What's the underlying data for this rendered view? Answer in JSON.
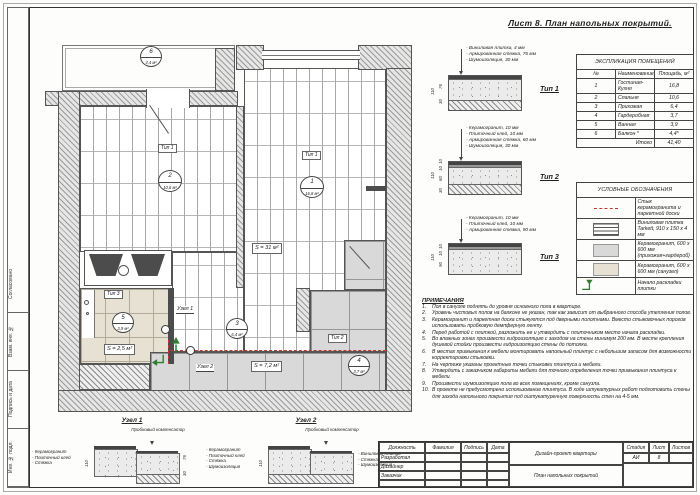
{
  "sheet": {
    "title": "Лист 8. План напольных покрытий."
  },
  "frame": {
    "stamps": [
      "Согласовано",
      "Взам. инв. №",
      "Подпись и дата",
      "Инв. № подл."
    ]
  },
  "explication": {
    "title": "ЭКСПЛИКАЦИЯ ПОМЕЩЕНИЙ",
    "col_num": "№",
    "col_name": "Наименование",
    "col_area": "Площадь, м²",
    "rows": [
      {
        "num": "1",
        "name": "Гостиная-Кухня",
        "area": "16,8"
      },
      {
        "num": "2",
        "name": "Спальня",
        "area": "10,6"
      },
      {
        "num": "3",
        "name": "Прихожая",
        "area": "6,4"
      },
      {
        "num": "4",
        "name": "Гардеробная",
        "area": "3,7"
      },
      {
        "num": "5",
        "name": "Ванная",
        "area": "3,9"
      },
      {
        "num": "6",
        "name": "Балкон *",
        "area": "4,4*"
      }
    ],
    "total_label": "Итого",
    "total": "41,40"
  },
  "legend": {
    "title": "УСЛОВНЫЕ ОБОЗНАЧЕНИЯ",
    "items": [
      {
        "label": "Стык керамогранита и паркетной доски"
      },
      {
        "label": "Виниловая плитка Tarkett, 910 х 150 х 4 мм"
      },
      {
        "label": "Керамогранит, 600 х 600 мм (прихожая+гардероб)"
      },
      {
        "label": "Керамогранит, 600 х 600 мм (санузел)"
      },
      {
        "label": "Начало раскладки плитки"
      }
    ]
  },
  "types": [
    {
      "name": "Тип 1",
      "lines": [
        "- Виниловая плитка, 4 мм",
        "- Армированная стяжка, 76 мм",
        "- Шумоизоляция, 30 мм"
      ],
      "dim_total": "110",
      "dims": [
        "76",
        "30"
      ]
    },
    {
      "name": "Тип 2",
      "lines": [
        "- Керамогранит, 10 мм",
        "- Плиточный клей, 10 мм",
        "- Армированная стяжка, 60 мм",
        "- Шумоизоляция, 30 мм"
      ],
      "dim_total": "110",
      "dims": [
        "10",
        "10",
        "60",
        "30"
      ]
    },
    {
      "name": "Тип 3",
      "lines": [
        "- Керамогранит, 10 мм",
        "- Плиточный клей, 10 мм",
        "- Армированная стяжка, 90 мм"
      ],
      "dim_total": "110",
      "dims": [
        "10",
        "10",
        "90"
      ]
    }
  ],
  "notes": {
    "title": "ПРИМЕЧАНИЯ",
    "items": [
      {
        "num": "1.",
        "text": "Пол в санузле поднять до уровня основного пола в квартире."
      },
      {
        "num": "2.",
        "text": "Уровень чистовых полов на балконе не указан, так как зависит от выбранного способа утепления полов."
      },
      {
        "num": "3.",
        "text": "Керамогранит и паркетная доска стыкуются под дверными полотнами. Вместо стыковочных порогов использовать пробковую демпферную ленту."
      },
      {
        "num": "4.",
        "text": "Перед работой с плиткой, разложить ее и утвердить с плиточником место начала раскладки."
      },
      {
        "num": "5.",
        "text": "Во влажных зонах произвести гидроизоляцию с заходом на стены минимум 200 мм. В месте крепления душевой стойки произвести гидроизоляцию стены до потолка."
      },
      {
        "num": "6.",
        "text": "В местах примыкания к мебели монтировать напольный плинтус с небольшим запасом для возможности корректировки стыковки."
      },
      {
        "num": "7.",
        "text": "На чертеже указаны проектные точки стыковки плинтуса и мебели."
      },
      {
        "num": "8.",
        "text": "Утвердить с заказчиком габариты мебели для точного определения точки примыкания плинтуса к мебели."
      },
      {
        "num": "9.",
        "text": "Произвести шумоизоляцию пола во всех помещениях, кроме санузла."
      },
      {
        "num": "10.",
        "text": "В проекте не предусмотрено использование плинтуса. В ходе штукатурных работ подготовить стены для захода напольного покрытия под оштукатуренную поверхность стен на 4-5 мм."
      }
    ]
  },
  "plan": {
    "markers": [
      {
        "num": "1",
        "area": "16,8 м²"
      },
      {
        "num": "2",
        "area": "10,6 м²"
      },
      {
        "num": "3",
        "area": "6,4 м²"
      },
      {
        "num": "4",
        "area": "3,7 м²"
      },
      {
        "num": "5",
        "area": "3,9 м²"
      },
      {
        "num": "6",
        "area": "4,4 м²"
      }
    ],
    "tags": {
      "bedroom": "Тип 1",
      "living": "Тип 1",
      "hall": "Тип 2",
      "bath": "Тип 3"
    },
    "s_living": "S = 31 м²",
    "s_bath": "S = 2,5 м²",
    "s_hall": "S = 7,2 м²",
    "node1": "Узел 1",
    "node2": "Узел 2"
  },
  "nodes": [
    {
      "title": "Узел 1",
      "comp": "Пробковый компенсатор",
      "left": [
        "- Керамогранит",
        "- Плиточный клей",
        "- Стяжка"
      ],
      "right": [],
      "dims_left": [
        "10",
        "110",
        "10",
        "90"
      ],
      "dims_right": [
        "76",
        "30"
      ]
    },
    {
      "title": "Узел 2",
      "comp": "Пробковый компенсатор",
      "left": [
        "- Керамогранит",
        "- Плиточный клей",
        "- Стяжка",
        "- Шумоизоляция"
      ],
      "right": [
        "- Виниловая плитка",
        "- Стяжка",
        "- Шумоизоляция"
      ],
      "dims_left": [
        "10",
        "110",
        "10",
        "60",
        "30"
      ],
      "dims_right": [
        "76",
        "30"
      ]
    }
  ],
  "titleblock": {
    "col_role": "Должность",
    "col_name": "Фамилия",
    "col_sign": "Подпись",
    "col_date": "Дата",
    "rows": [
      "Разработал",
      "Дизайнер",
      "Заказчик"
    ],
    "project": "Дизайн-проект квартиры",
    "doc": "План напольных покрытий",
    "stage_label": "Стадия",
    "sheet_label": "Лист",
    "sheets_label": "Листов",
    "stage": "АИ",
    "sheet_num": "8",
    "sheets": ""
  },
  "colors": {
    "joint_red": "#c0392b",
    "start_green": "#2e7d32",
    "tile_gray": "#d9d9d9",
    "tile_beige": "#e7e1d3"
  }
}
